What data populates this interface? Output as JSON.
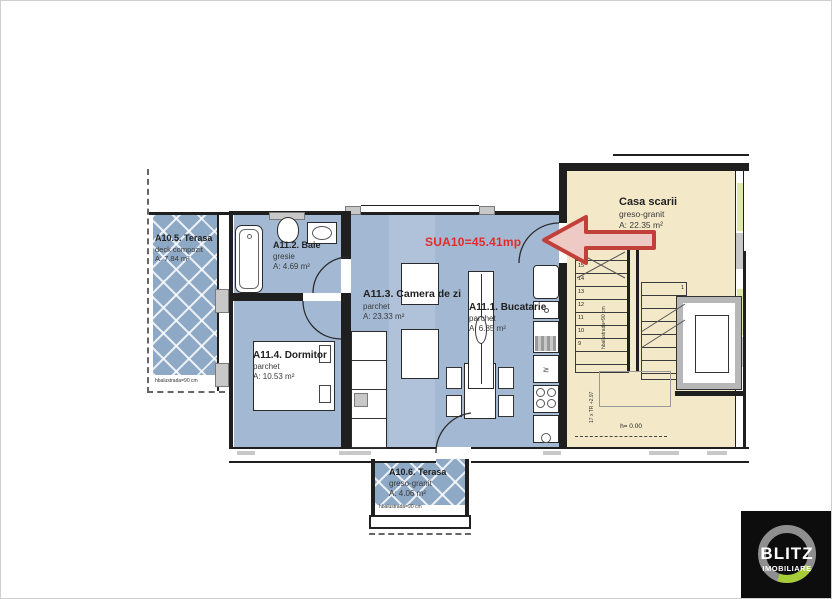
{
  "annotation": {
    "text": "SUA10=45.41mp"
  },
  "rooms": {
    "terasa_a105": {
      "name": "A10.5. Terasa",
      "finish": "deck compozit",
      "area": "A: 7.84 m²",
      "note": "hbalustrada=90 cm"
    },
    "baie": {
      "name": "A11.2. Baie",
      "finish": "gresie",
      "area": "A: 4.69 m²"
    },
    "camera_de_zi": {
      "name": "A11.3. Camera de zi",
      "finish": "parchet",
      "area": "A: 23.33 m²"
    },
    "bucatarie": {
      "name": "A11.1. Bucatarie",
      "finish": "parchet",
      "area": "A: 6.85 m²"
    },
    "dormitor": {
      "name": "A11.4. Dormitor",
      "finish": "parchet",
      "area": "A: 10.53 m²"
    },
    "terasa_a106": {
      "name": "A10.6. Terasa",
      "finish": "greso-granit",
      "area": "A: 4.06 m²",
      "note": "hbalustrada=90 cm"
    },
    "casa_scarii": {
      "name": "Casa scarii",
      "finish": "greso-granit",
      "area": "A: 22.35 m²"
    }
  },
  "stairs": {
    "left_steps": [
      "16",
      "15",
      "14",
      "13",
      "12",
      "11",
      "10",
      "9"
    ],
    "right_steps": [
      "1",
      "2",
      "3",
      "4",
      "5",
      "6",
      "7"
    ],
    "rail_note": "hbalustrada=90 cm",
    "run_note": "17 x TR +2.97",
    "level_note": "h= 0.00"
  },
  "logo": {
    "line1": "BLITZ",
    "line2": "IMOBILIARE"
  },
  "colors": {
    "floor": "#a3b9d3",
    "stairwell": "#f3e9c9",
    "accent_red": "#e42a28",
    "logo_green": "#a6cc3a"
  }
}
